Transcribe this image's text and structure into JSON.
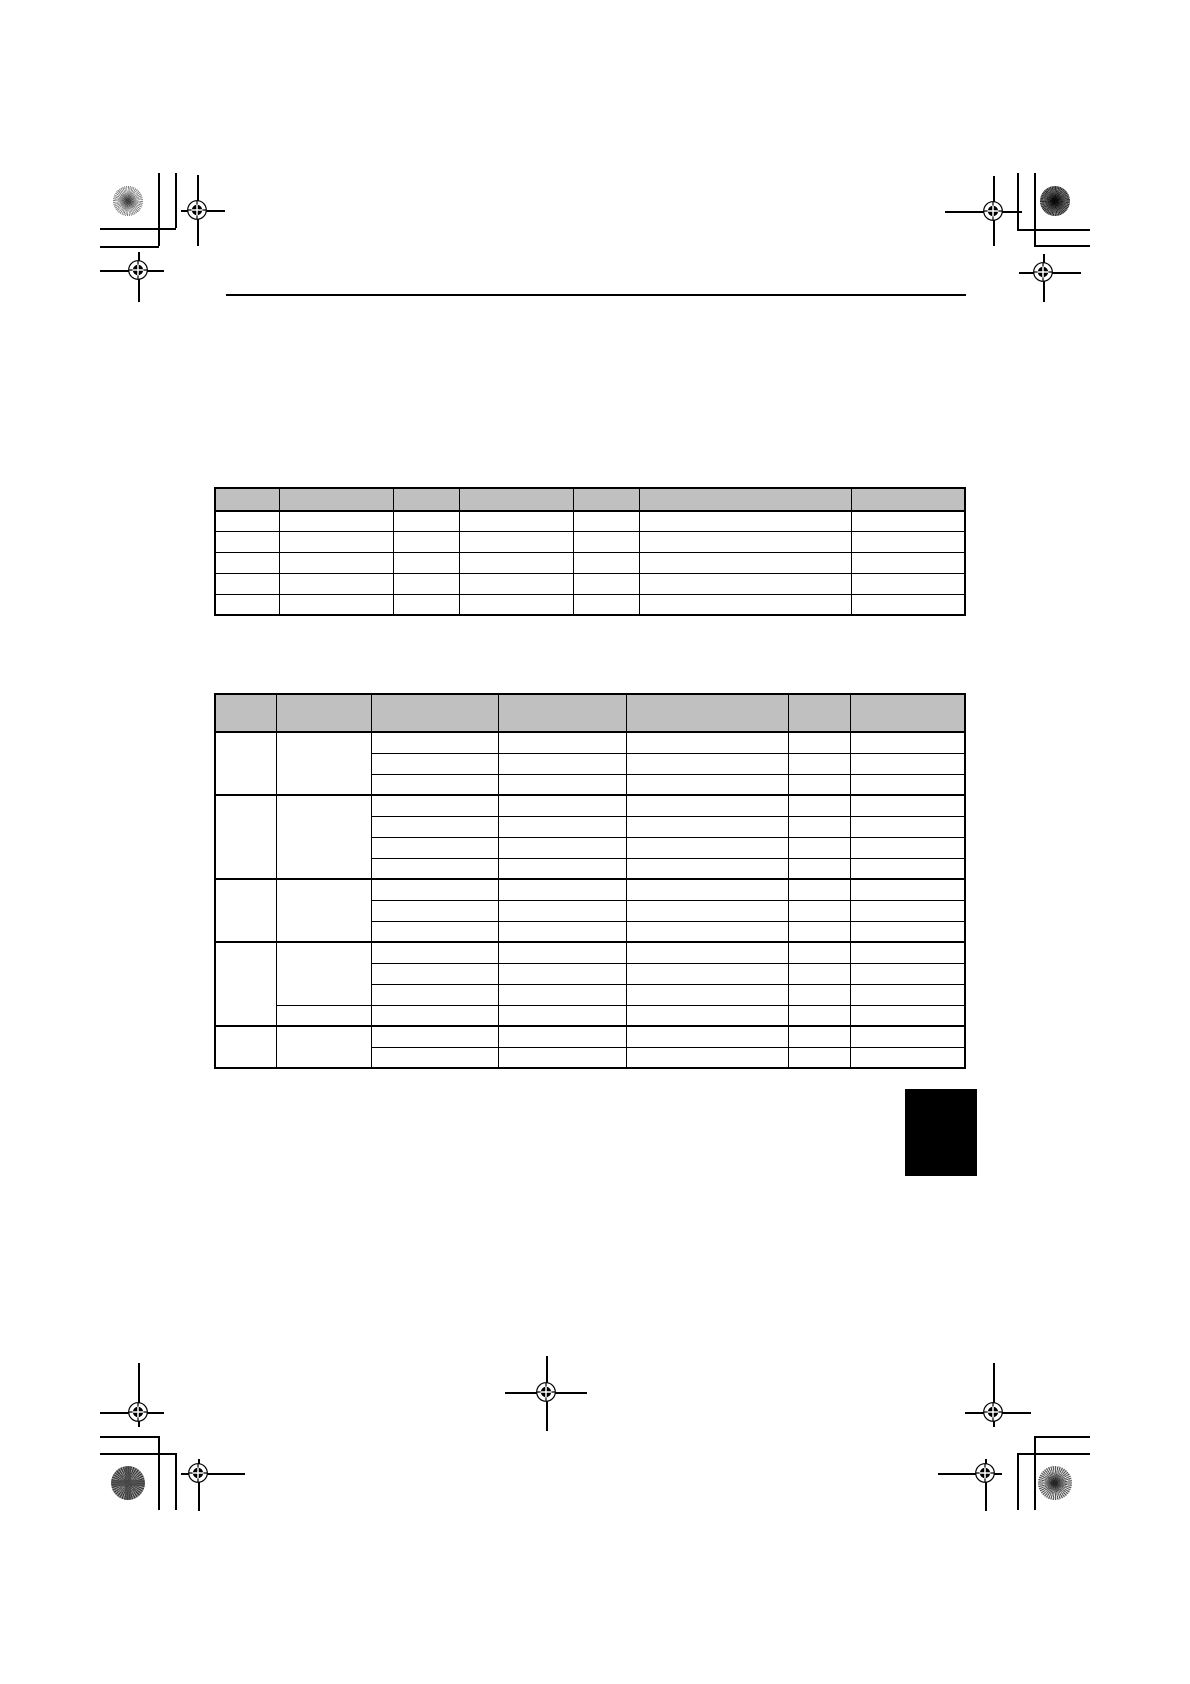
{
  "document": {
    "kind": "print-proof-page",
    "background": "#ffffff",
    "width_px": 1190,
    "height_px": 1684,
    "visible_text": ""
  },
  "colors": {
    "table_header_bg": "#c0c0c0",
    "line": "#000000",
    "side_tab": "#000000",
    "page_bg": "#ffffff"
  },
  "header_rule": {
    "present": true,
    "x": 226,
    "y": 294,
    "width": 740,
    "thickness": 2
  },
  "tables": [
    {
      "id": "table-1",
      "x": 216,
      "y": 489,
      "header_height": 23,
      "row_height": 20.8,
      "col_widths": [
        64,
        114,
        66,
        114,
        66,
        212,
        114
      ],
      "thick_groups": false,
      "groups": [
        {
          "rows": 1
        },
        {
          "rows": 1
        },
        {
          "rows": 1
        },
        {
          "rows": 1
        },
        {
          "rows": 1
        }
      ],
      "header_labels": [
        "",
        "",
        "",
        "",
        "",
        "",
        ""
      ],
      "cells_empty": true
    },
    {
      "id": "table-2",
      "x": 216,
      "y": 695,
      "header_height": 38,
      "row_height": 21,
      "col_widths": [
        61,
        95,
        127,
        128,
        162,
        62,
        115
      ],
      "thick_groups": true,
      "groups": [
        {
          "rows": 3
        },
        {
          "rows": 4
        },
        {
          "rows": 3
        },
        {
          "rows": 4,
          "col2_split": 3
        },
        {
          "rows": 2
        }
      ],
      "header_labels": [
        "",
        "",
        "",
        "",
        "",
        "",
        ""
      ],
      "cells_empty": true
    }
  ],
  "marks": {
    "registration_mark_icon": "crosshair-in-circle",
    "registration_mark_count": 9,
    "pinwheel_icon": "radial-starburst-circle",
    "pinwheel_count": 4,
    "corner_trim_marks": true,
    "side_tab": {
      "filled": true,
      "x": 905,
      "y": 1089,
      "width": 72,
      "height": 87
    }
  }
}
